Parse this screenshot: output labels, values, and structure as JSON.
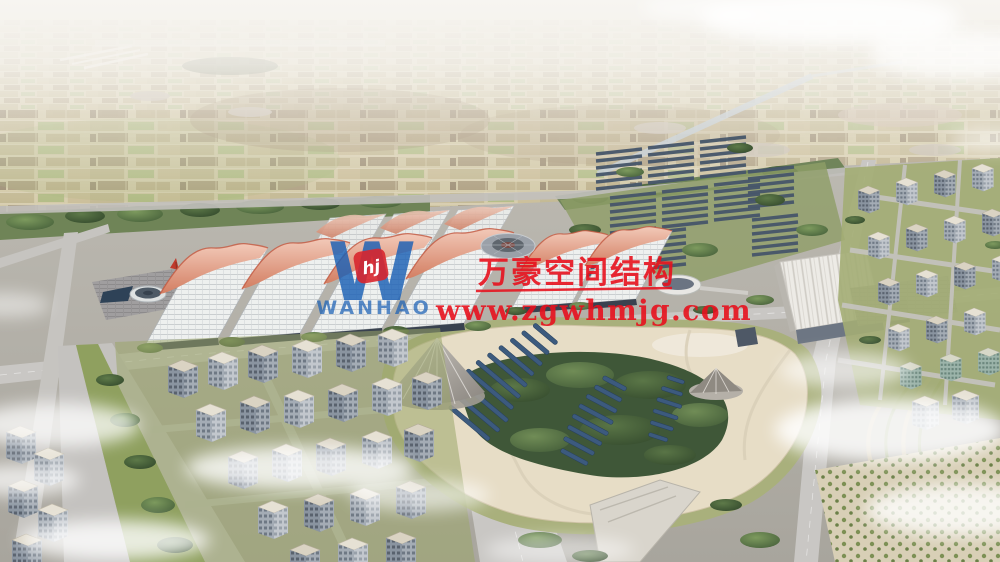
{
  "watermark": {
    "company_name": "万豪空间结构",
    "website": "www.zgwhmjg.com",
    "logo": {
      "letter": "W",
      "badge": "hj",
      "wordmark": "WANHAO"
    },
    "text_color": "#e7111d",
    "logo_color": "#1a5fb4"
  },
  "scene": {
    "description": "Aerial architectural rendering of a large exhibition-center campus: rows of white grid-roof halls with pink wave canopies, a central park with solar panel rows and tent cones, surrounding city blocks, farmland fading to a hazy horizon, scattered clouds.",
    "palette": {
      "haze_white": "#f6f4f0",
      "farmland_tan": "#cec49f",
      "farmland_green": "#a8b478",
      "farmland_brown": "#8f7f62",
      "canal_blue": "#b4c2cf",
      "tree_green": "#54703f",
      "lawn_green": "#9aa569",
      "road_gray": "#c9c7c4",
      "ground_gray": "#b2afa8",
      "hall_roof_white": "#eef0ef",
      "hall_wall_navy": "#39424f",
      "wave_pink": "#e2a493",
      "wave_crest_red": "#c25740",
      "pavilion_white": "#edebe6",
      "solar_panel_blue": "#3c5a7e",
      "greenhouse_slate": "#46566a",
      "building_facade": "#8a94a0",
      "building_roof": "#dad3c3",
      "pond_navy": "#2e4257",
      "park_sand": "#e7ddc6",
      "cloud_white": "#ffffff"
    }
  }
}
